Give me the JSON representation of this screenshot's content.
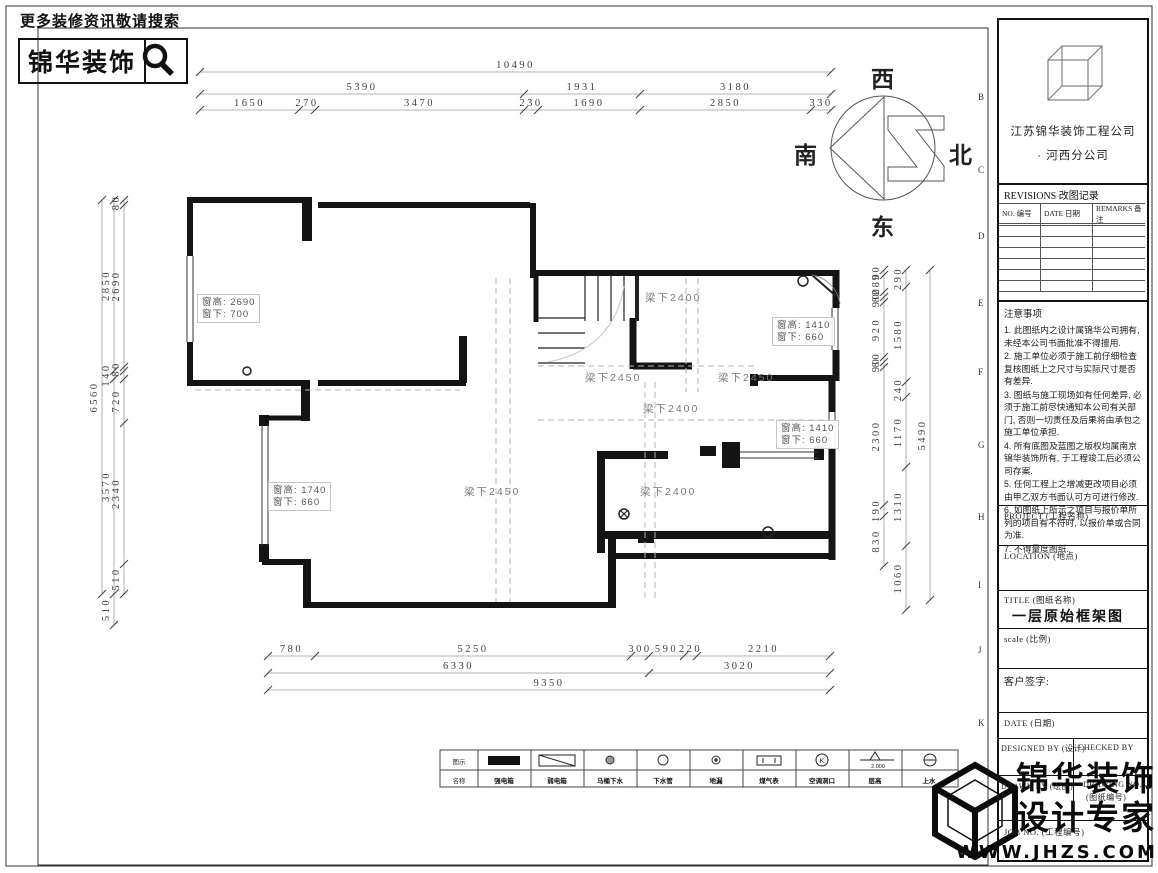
{
  "promo": {
    "text": "更多装修资讯敬请搜索",
    "brand": "锦华装饰"
  },
  "compass": {
    "west": "西",
    "south": "南",
    "north": "北",
    "east": "东",
    "mark": "Z"
  },
  "sheet": {
    "grid_letters": [
      "B",
      "C",
      "D",
      "E",
      "F",
      "G",
      "H",
      "I",
      "J",
      "K"
    ]
  },
  "plan": {
    "windows": [
      {
        "line1": "窗高: 2690",
        "line2": "窗下: 700"
      },
      {
        "line1": "窗高: 1410",
        "line2": "窗下: 660"
      },
      {
        "line1": "窗高: 1410",
        "line2": "窗下: 660"
      },
      {
        "line1": "窗高: 1740",
        "line2": "窗下: 660"
      }
    ],
    "beams": [
      "梁下2400",
      "梁下2450",
      "梁下2450",
      "梁下2400",
      "梁下2450",
      "梁下2400"
    ]
  },
  "dimensions": {
    "chains": [
      {
        "dir": "h",
        "pos": 72,
        "segs": [
          {
            "a": 200,
            "b": 831,
            "t": "10490"
          }
        ]
      },
      {
        "dir": "h",
        "pos": 94,
        "segs": [
          {
            "a": 200,
            "b": 524,
            "t": "5390"
          },
          {
            "a": 524,
            "b": 640,
            "t": "1931"
          },
          {
            "a": 640,
            "b": 831,
            "t": "3180"
          }
        ]
      },
      {
        "dir": "h",
        "pos": 110,
        "segs": [
          {
            "a": 200,
            "b": 299,
            "t": "1650"
          },
          {
            "a": 299,
            "b": 315,
            "t": "270"
          },
          {
            "a": 315,
            "b": 524,
            "t": "3470"
          },
          {
            "a": 524,
            "b": 538,
            "t": "230"
          },
          {
            "a": 538,
            "b": 640,
            "t": "1690"
          },
          {
            "a": 640,
            "b": 811,
            "t": "2850"
          },
          {
            "a": 811,
            "b": 831,
            "t": "330"
          }
        ]
      },
      {
        "dir": "h",
        "pos": 656,
        "segs": [
          {
            "a": 268,
            "b": 315,
            "t": "780"
          },
          {
            "a": 315,
            "b": 631,
            "t": "5250"
          },
          {
            "a": 631,
            "b": 649,
            "t": "300"
          },
          {
            "a": 649,
            "b": 684,
            "t": "590"
          },
          {
            "a": 684,
            "b": 697,
            "t": "220"
          },
          {
            "a": 697,
            "b": 830,
            "t": "2210"
          }
        ]
      },
      {
        "dir": "h",
        "pos": 673,
        "segs": [
          {
            "a": 268,
            "b": 649,
            "t": "6330"
          },
          {
            "a": 649,
            "b": 830,
            "t": "3020"
          }
        ]
      },
      {
        "dir": "h",
        "pos": 690,
        "segs": [
          {
            "a": 268,
            "b": 830,
            "t": "9350"
          }
        ]
      },
      {
        "dir": "v",
        "pos": 102,
        "segs": [
          {
            "a": 200,
            "b": 594,
            "t": "6560"
          }
        ]
      },
      {
        "dir": "v",
        "pos": 114,
        "segs": [
          {
            "a": 200,
            "b": 371,
            "t": "2850"
          },
          {
            "a": 371,
            "b": 379,
            "t": "140"
          },
          {
            "a": 379,
            "b": 594,
            "t": "3570"
          },
          {
            "a": 594,
            "b": 625,
            "t": "510"
          }
        ]
      },
      {
        "dir": "v",
        "pos": 124,
        "segs": [
          {
            "a": 200,
            "b": 205,
            "t": "80"
          },
          {
            "a": 205,
            "b": 367,
            "t": "2690"
          },
          {
            "a": 367,
            "b": 371,
            "t": "80"
          },
          {
            "a": 379,
            "b": 423,
            "t": "720"
          },
          {
            "a": 423,
            "b": 564,
            "t": "2340"
          },
          {
            "a": 564,
            "b": 594,
            "t": "510"
          }
        ]
      },
      {
        "dir": "v",
        "pos": 884,
        "segs": [
          {
            "a": 270,
            "b": 275,
            "t": "90"
          },
          {
            "a": 275,
            "b": 292,
            "t": "280"
          },
          {
            "a": 292,
            "b": 297,
            "t": "80"
          },
          {
            "a": 297,
            "b": 302,
            "t": "90"
          },
          {
            "a": 302,
            "b": 357,
            "t": "920"
          },
          {
            "a": 357,
            "b": 362,
            "t": "80"
          },
          {
            "a": 362,
            "b": 367,
            "t": "90"
          },
          {
            "a": 367,
            "b": 505,
            "t": "2300"
          },
          {
            "a": 505,
            "b": 516,
            "t": "190"
          },
          {
            "a": 516,
            "b": 566,
            "t": "830"
          }
        ]
      },
      {
        "dir": "v",
        "pos": 906,
        "segs": [
          {
            "a": 270,
            "b": 287,
            "t": "290"
          },
          {
            "a": 287,
            "b": 382,
            "t": "1580"
          },
          {
            "a": 382,
            "b": 397,
            "t": "240"
          },
          {
            "a": 397,
            "b": 467,
            "t": "1170"
          },
          {
            "a": 467,
            "b": 546,
            "t": "1310"
          },
          {
            "a": 546,
            "b": 610,
            "t": "1060"
          }
        ]
      },
      {
        "dir": "v",
        "pos": 930,
        "segs": [
          {
            "a": 270,
            "b": 600,
            "t": "5490"
          }
        ]
      }
    ]
  },
  "legend": {
    "symbol_header": "图示",
    "name_header": "名称",
    "level_value": "2.000",
    "ac_mark": "K",
    "items": [
      {
        "icon": "strong-power-box-icon",
        "name": "强电箱"
      },
      {
        "icon": "weak-power-box-icon",
        "name": "弱电箱"
      },
      {
        "icon": "toilet-drain-icon",
        "name": "马桶下水"
      },
      {
        "icon": "sewer-pipe-icon",
        "name": "下水管"
      },
      {
        "icon": "floor-drain-icon",
        "name": "地漏"
      },
      {
        "icon": "gas-meter-icon",
        "name": "煤气表"
      },
      {
        "icon": "ac-opening-icon",
        "name": "空调洞口"
      },
      {
        "icon": "level-mark-icon",
        "name": "层高"
      },
      {
        "icon": "water-supply-icon",
        "name": "上水"
      }
    ]
  },
  "titleblock": {
    "company_line1": "江苏锦华装饰工程公司",
    "company_line2": "·  河西分公司",
    "revisions_title": "REVISIONS 改图记录",
    "rev_cols": [
      "NO. 编号",
      "DATE 日期",
      "REMARKS 备注"
    ],
    "notes_title": "注意事项",
    "notes": [
      "1. 此图纸内之设计属锦华公司拥有, 未经本公司书面批准不得擅用.",
      "2. 施工单位必须于施工前仔细检查复核图纸上之尺寸与实际尺寸是否有差异.",
      "3. 图纸与施工现场如有任何差异, 必须于施工前尽快通知本公司有关部门, 否则一切责任及后果将由承包之施工单位承担.",
      "4. 所有底图及蓝图之版权均属南京锦华装饰所有, 于工程竣工后必须公司存案.",
      "5. 任何工程上之增减更改项目必须由甲乙双方书面认可方可进行修改.",
      "6. 如图纸上所示之项目与报价单所列的项目有不符时, 以报价单或合同为准.",
      "7. 不得量度图纸."
    ],
    "project_label": "PROJECT (工程名称)",
    "location_label": "LOCATION (地点)",
    "title_label": "TITLE (图纸名称)",
    "drawing_title": "一层原始框架图",
    "scale_label": "scale  (比例)",
    "client_sign_label": "客户签字:",
    "date_label": "DATE (日期)",
    "designed_by_label": "DESIGNED BY (设计)",
    "checked_by_label": "CHECKED BY",
    "drawn_by_label": "DRAWN BY (绘图)",
    "drawing_no_label": "DRAWING NO.",
    "drawing_no_label2": "(图纸编号)",
    "job_label": "JOB NO. (工程编号)"
  },
  "footer": {
    "brand_line1": "锦华装饰",
    "brand_line2": "设计专家",
    "website": "WWW.JHZS.COM"
  }
}
